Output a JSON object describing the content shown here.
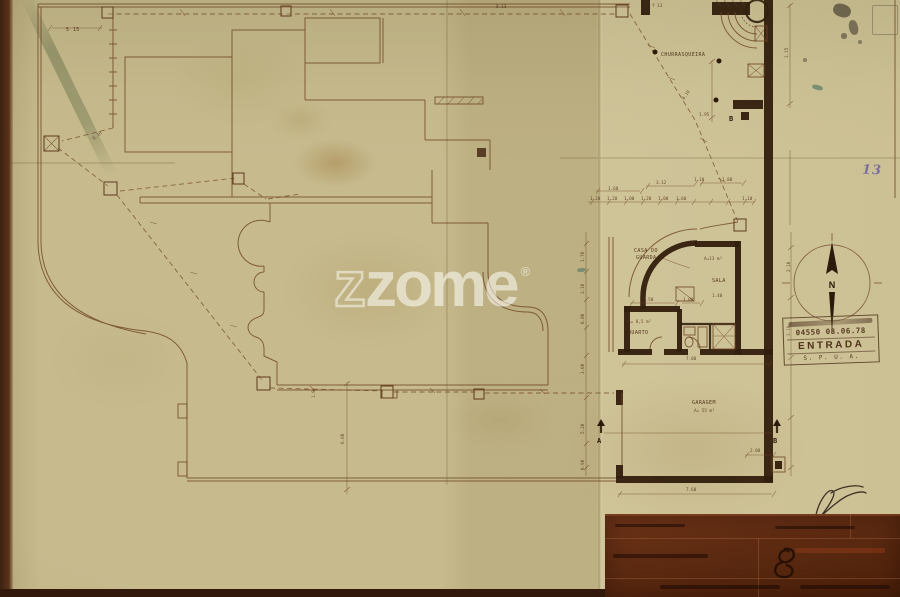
{
  "document": {
    "page_number": "13"
  },
  "watermark": {
    "z_outline": "z",
    "word": "zome",
    "registered": "®"
  },
  "compass": {
    "north": "N"
  },
  "stamp": {
    "numbers": "04550  08.06.78",
    "word": "ENTRADA",
    "org": "S. P. U. A."
  },
  "plan": {
    "labels": {
      "churrasqueira": "CHURRASQUEIRA",
      "casa1": "CASA DO",
      "casa2": "GUARDA",
      "sala": "SALA",
      "sala_area": "A=13 m²",
      "quarto": "QUARTO",
      "quarto_area": "A= 8,5 m²",
      "garagem": "GARAGEM",
      "garagem_area": "A= 55 m²",
      "marker_a": "A",
      "marker_b": "B",
      "marker_b_top": "B",
      "d_515": "5 15",
      "d_813": "8.13",
      "d_f13": "f 13",
      "d_810_left": "8.10",
      "d_810_right": "8.10",
      "d_195": "1.95",
      "d_115": "1.15",
      "d_160": "1.60",
      "d_312": "3.12",
      "d_110": "1.10",
      "d_180": "1.80",
      "s_120a": "1.20",
      "s_120b": "1.20",
      "s_100a": "1.00",
      "s_120c": "1.20",
      "s_100b": "1.00",
      "s_160b": "1.60",
      "s_110b": "1.10",
      "v_170": "1.70",
      "v_310": "3.10",
      "v_080": "0.80",
      "v_300": "3.00",
      "v_520": "5.20",
      "v_090": "0.90",
      "r_210": "2.10",
      "r_310": "3.10",
      "d_700": "7.00",
      "d_760": "7.60",
      "d_200": "2.00",
      "d_660": "6.60",
      "d_19": "1.9",
      "d_350": "3.50",
      "d_100": "1.00",
      "d_140": "1.40"
    }
  },
  "colors": {
    "paper": "#c7bb8e",
    "ink_thin": "#6d4323",
    "ink_wall": "#311d0c",
    "title_block": "#5c2a11",
    "stamp_ink": "#4a2c16",
    "page_number_ink": "#6f63a6",
    "watermark": "rgba(255,255,252,0.55)"
  }
}
